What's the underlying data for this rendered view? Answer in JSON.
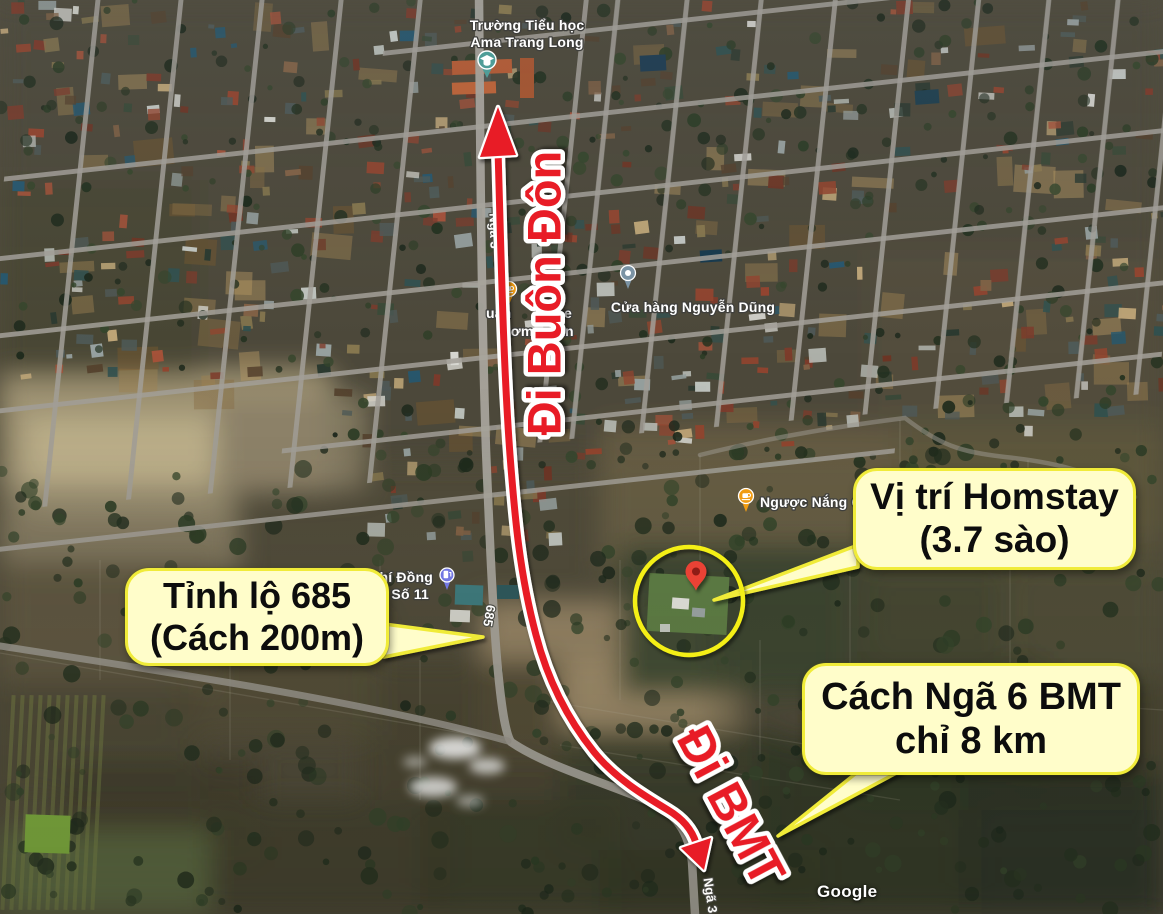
{
  "map_overlay": {
    "watermark": "Google",
    "poi_labels": {
      "school": {
        "line1": "Trường Tiểu học",
        "line2": "Ama Trang Long"
      },
      "cafe_fragments": {
        "f1": "uán",
        "f2": "ee",
        "f3": "hơm",
        "f4": "ăn"
      },
      "store": {
        "label": "Cửa hàng Nguyễn Dũng"
      },
      "cafe2": {
        "label": "Ngược Nắng C"
      },
      "gas": {
        "line1": "hí Đồng",
        "line2": "Số 11"
      }
    },
    "road_labels": {
      "north": "Ngã 3",
      "route685": "685",
      "south": "Ngã 3"
    }
  },
  "annotations": {
    "direction_north": "Đi Buôn Đôn",
    "direction_south": "Đi BMT",
    "callouts": {
      "homestay": {
        "line1": "Vị trí Homstay",
        "line2": "(3.7 sào)"
      },
      "road685": {
        "line1": "Tỉnh lộ 685",
        "line2": "(Cách 200m)"
      },
      "bmt": {
        "line1": "Cách Ngã 6 BMT",
        "line2": "chỉ 8 km"
      }
    },
    "colors": {
      "route_red": "#e81f27",
      "callout_fill": "#fffdca",
      "callout_border": "#f0eb39",
      "highlight_circle": "#f4ef16",
      "marker_red": "#ea4335",
      "marker_dot": "#8e1a12",
      "pin_school": "#4f9d98",
      "pin_cafe": "#f09c13",
      "pin_store": "#7b93a4",
      "pin_gas": "#7277e2"
    }
  }
}
